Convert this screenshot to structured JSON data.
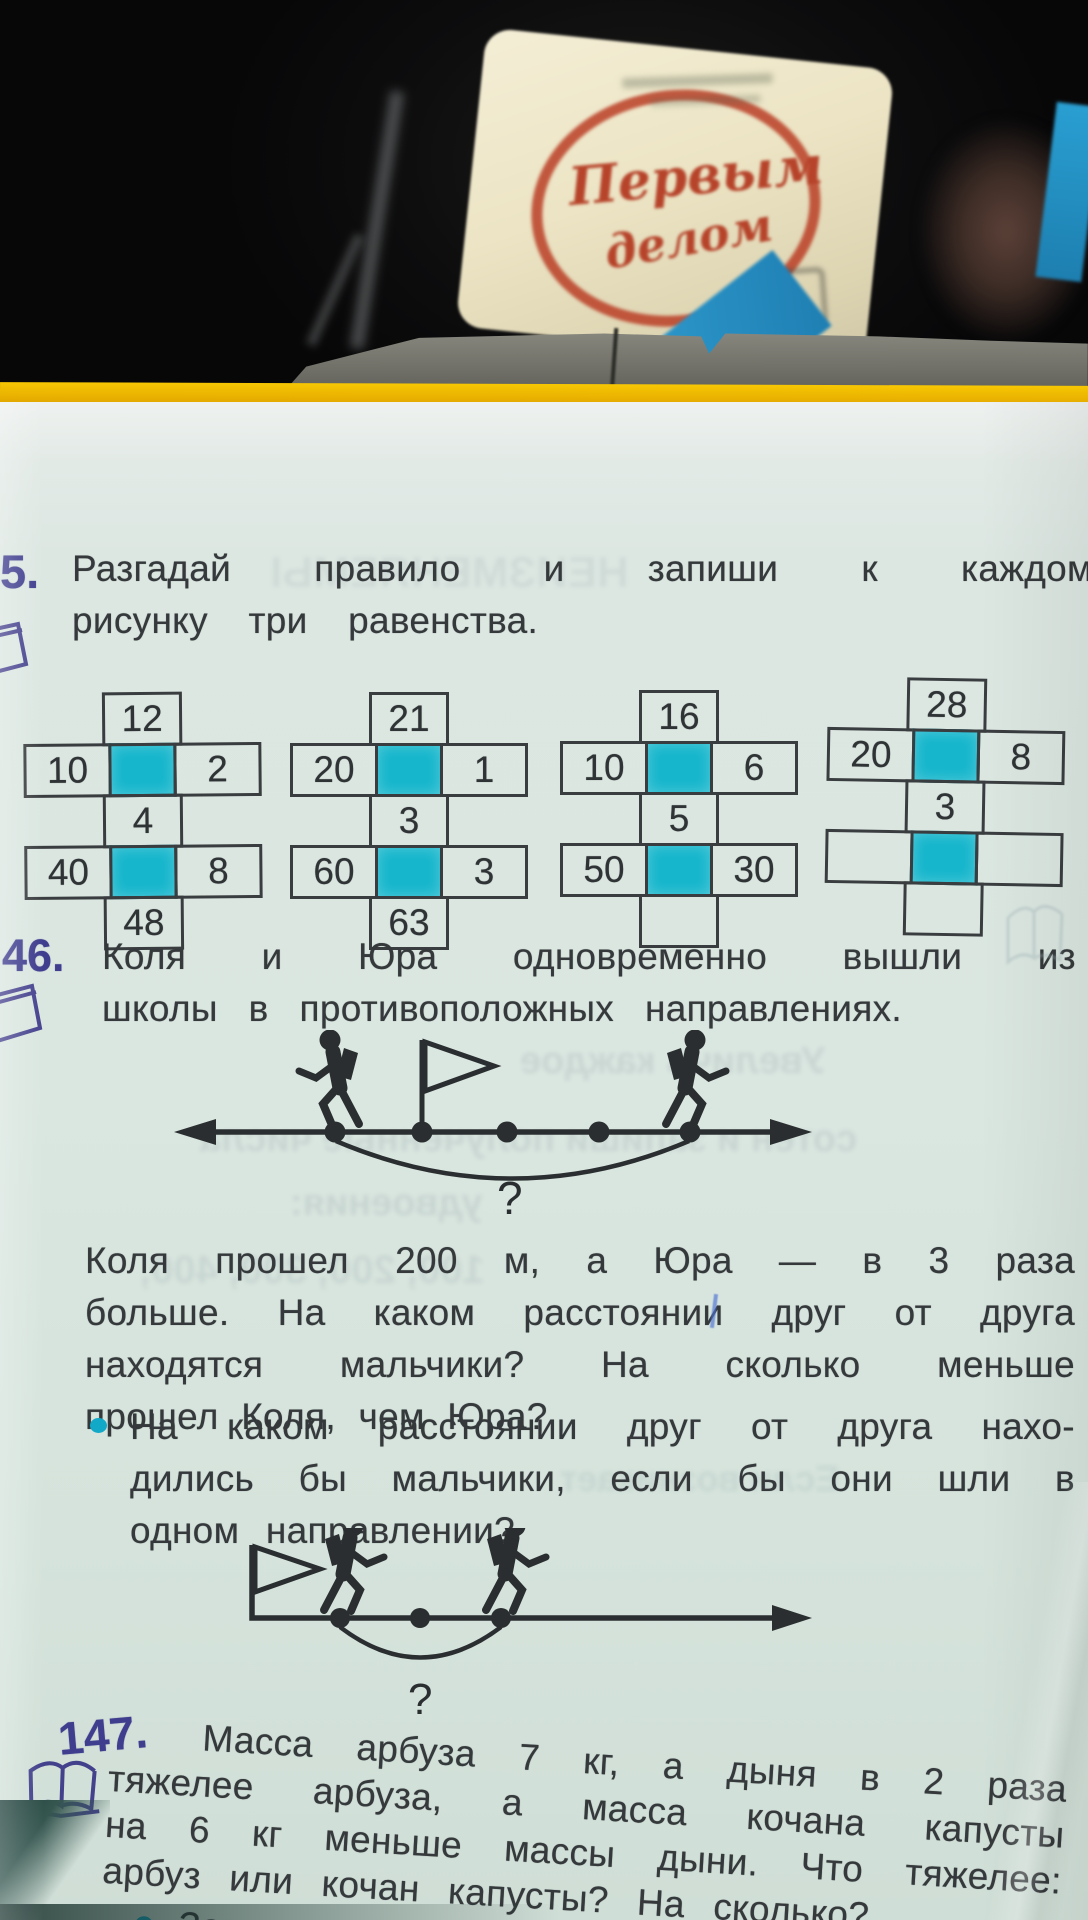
{
  "photo": {
    "package_script_line1": "Первым",
    "package_script_line2": "делом"
  },
  "exercise5": {
    "number": "5.",
    "line1": "Разгадай правило и запиши к каждому",
    "line2": "рисунку три равенства."
  },
  "crosses": [
    {
      "top": "12",
      "left1": "10",
      "right1": "2",
      "mid": "4",
      "left2": "40",
      "right2": "8",
      "bottom": "48"
    },
    {
      "top": "21",
      "left1": "20",
      "right1": "1",
      "mid": "3",
      "left2": "60",
      "right2": "3",
      "bottom": "63"
    },
    {
      "top": "16",
      "left1": "10",
      "right1": "6",
      "mid": "5",
      "left2": "50",
      "right2": "30",
      "bottom": ""
    },
    {
      "top": "28",
      "left1": "20",
      "right1": "8",
      "mid": "3",
      "left2": "",
      "right2": "",
      "bottom": ""
    }
  ],
  "exercise146": {
    "number": "46.",
    "intro_line1": "Коля и Юра одновременно вышли из",
    "intro_line2": "школы в противоположных направлениях.",
    "body_line1": "Коля прошел 200 м, а Юра — в 3 раза",
    "body_line2": "больше. На каком расстоянии друг от друга",
    "body_line3": "находятся мальчики? На сколько меньше",
    "body_line4": "прошел Коля, чем Юра?",
    "bullet_line1": "На каком расстоянии друг от друга нахо-",
    "bullet_line2": "дились бы мальчики, если бы они шли в",
    "bullet_line3": "одном направлении?",
    "diagram1_question": "?",
    "diagram2_question": "?"
  },
  "exercise147": {
    "number": "147.",
    "body_line1": "Масса арбуза 7 кг, а дыня в 2 раза",
    "body_line2": "тяжелее арбуза, а масса кочана капусты",
    "body_line3": "на 6 кг меньше массы дыни. Что тяжелее:",
    "body_line4": "арбуз или кочан капусты? На сколько?",
    "bullet_line": "Запиши решение задачи по действиям."
  },
  "ghosts": [
    "НЕИЗМЕНЯЕМЫ",
    "Увеличь каждое",
    "сотен и запиши полученные числа",
    "удвоения:",
    "100, 200, 300, 400,",
    "Если возникает"
  ],
  "colors": {
    "teal_square": "#16b6cc",
    "accent_indigo": "#3f3d8e",
    "bullet_teal": "#12a8c8",
    "cover_yellow": "#eab000"
  }
}
